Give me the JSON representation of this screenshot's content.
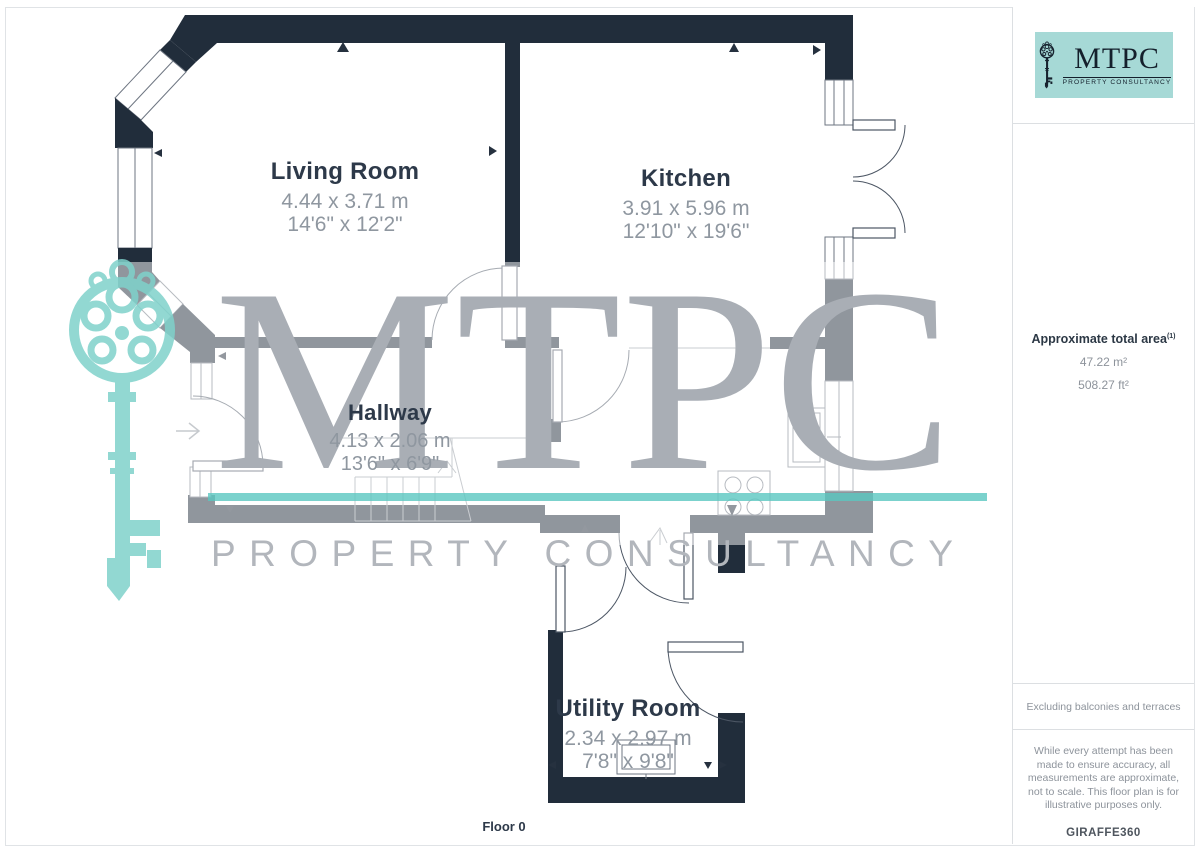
{
  "page": {
    "floor_label": "Floor 0"
  },
  "rooms": [
    {
      "id": "living-room",
      "name": "Living Room",
      "dim_m": "4.44 x 3.71 m",
      "dim_ft": "14'6\" x 12'2\""
    },
    {
      "id": "kitchen",
      "name": "Kitchen",
      "dim_m": "3.91 x 5.96 m",
      "dim_ft": "12'10\" x 19'6\""
    },
    {
      "id": "hallway",
      "name": "Hallway",
      "dim_m": "4.13 x 2.06 m",
      "dim_ft": "13'6\" x 6'9\""
    },
    {
      "id": "utility-room",
      "name": "Utility Room",
      "dim_m": "2.34 x 2.97 m",
      "dim_ft": "7'8\" x 9'8\""
    }
  ],
  "watermark": {
    "brand": "MTPC",
    "tagline": "PROPERTY CONSULTANCY"
  },
  "logo": {
    "brand": "MTPC",
    "tagline": "PROPERTY CONSULTANCY"
  },
  "sidebar": {
    "area_title": "Approximate total area",
    "area_superscript": "(1)",
    "area_m2": "47.22 m²",
    "area_ft2": "508.27 ft²",
    "exclusion_note": "Excluding balconies and terraces",
    "disclaimer": "While every attempt has been made to ensure accuracy, all measurements are approximate, not to scale. This floor plan is for illustrative purposes only.",
    "provider": "GIRAFFE360"
  },
  "colors": {
    "wall": "#212d3b",
    "label_title": "#2d3949",
    "label_dim": "#8f97a0",
    "brand_teal": "#a6d9d6",
    "watermark_teal": "#5ac7c0",
    "watermark_gray": "#a9aeb5"
  }
}
